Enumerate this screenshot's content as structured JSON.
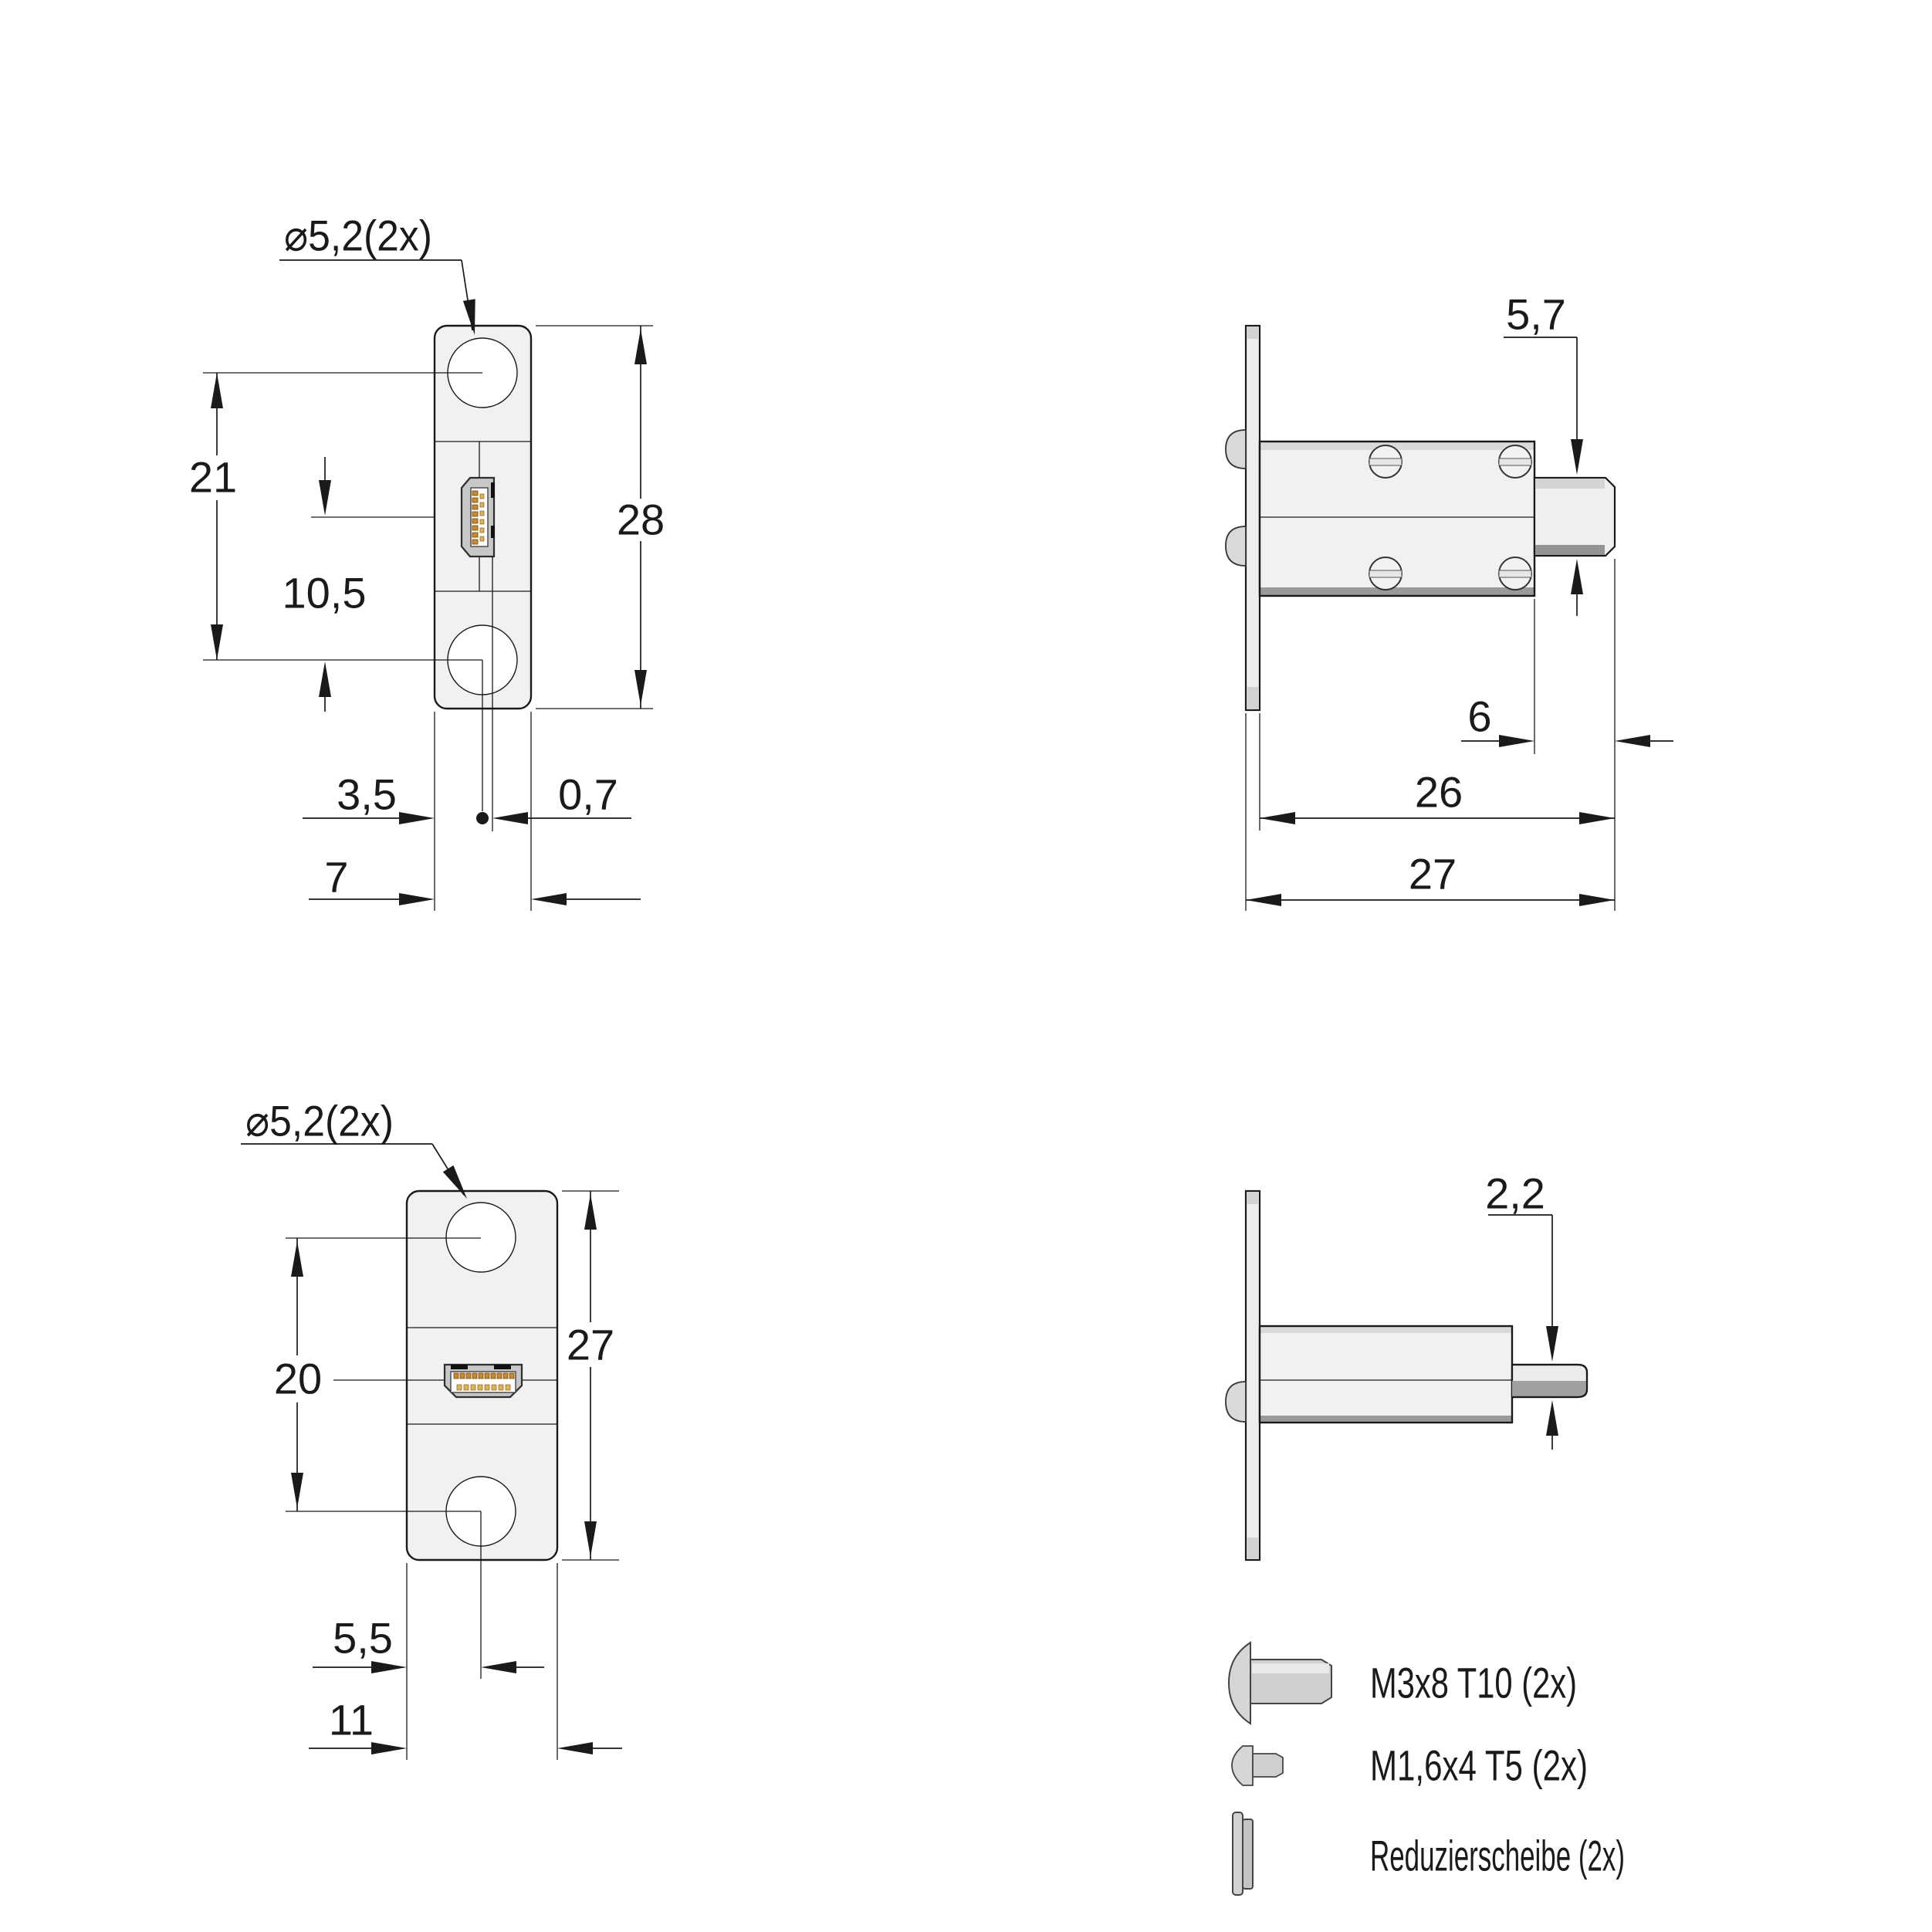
{
  "drawing": {
    "kind": "technical-drawing",
    "views": {
      "front_top": {
        "name": "mini-hdmi-panel-front-view",
        "dims": {
          "hole_diameter": "⌀5,2(2x)",
          "hole_spacing": "21",
          "connector_to_hole": "10,5",
          "plate_height": "28",
          "edge_to_center": "3,5",
          "center_offset": "0,7",
          "plate_width": "7"
        }
      },
      "side_top": {
        "name": "mini-hdmi-panel-side-view",
        "dims": {
          "plug_height": "5,7",
          "plug_length": "6",
          "depth_from_face": "26",
          "total_depth": "27"
        }
      },
      "front_bottom": {
        "name": "hdmi-panel-front-view",
        "dims": {
          "hole_diameter": "⌀5,2(2x)",
          "hole_spacing": "20",
          "plate_height": "27",
          "edge_to_center": "5,5",
          "plate_width": "11"
        }
      },
      "side_bottom": {
        "name": "hdmi-panel-side-view",
        "dims": {
          "pin_height": "2,2"
        }
      }
    },
    "legend": {
      "items": [
        {
          "icon": "screw-m3-icon",
          "label": "M3x8 T10 (2x)"
        },
        {
          "icon": "screw-m16-icon",
          "label": "M1,6x4 T5 (2x)"
        },
        {
          "icon": "washer-icon",
          "label": "Reduzierscheibe (2x)"
        }
      ]
    },
    "colors": {
      "line": "#1a1a1a",
      "part_fill": "#f1f1f1",
      "plate_fill": "#ededed",
      "shade_light": "#d9d9d9",
      "shade_dark": "#9a9a9a",
      "connector_shell": "#c7c7c7",
      "pad_gold_dark": "#c98a2e",
      "pad_gold_light": "#e0b253",
      "background": "#ffffff"
    }
  }
}
